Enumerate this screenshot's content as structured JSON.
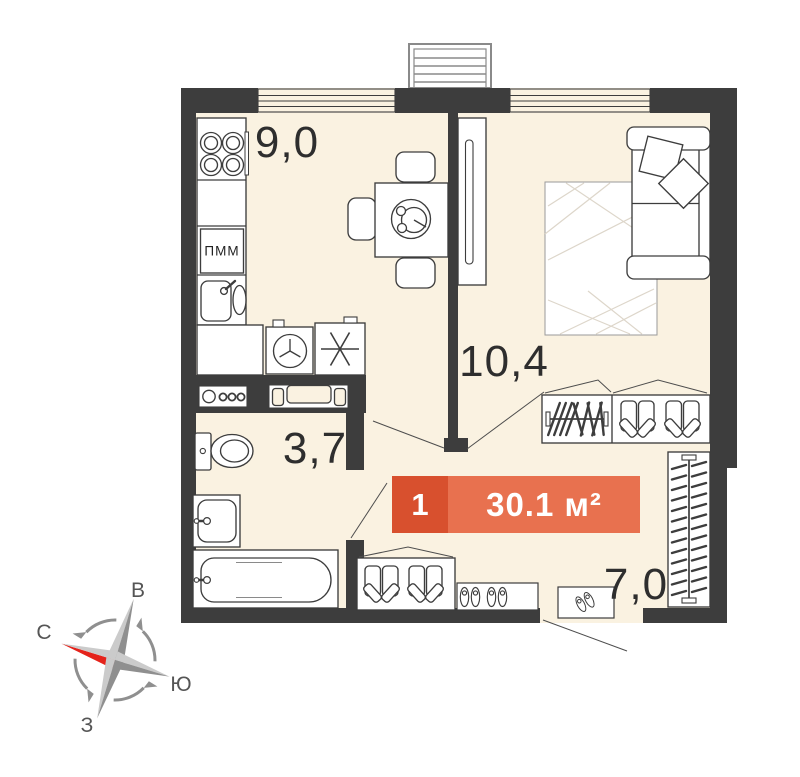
{
  "plan": {
    "rooms": {
      "kitchen": "9,0",
      "living": "10,4",
      "bathroom": "3,7",
      "hallway": "7,0"
    },
    "badge": {
      "number": "1",
      "area": "30.1 м²"
    },
    "labels": {
      "dishwasher": "ПММ"
    },
    "colors": {
      "wall": "#3d3d3d",
      "floor": "#faf2e1",
      "badge_left": "#d8502e",
      "badge_right": "#e8714f",
      "compass_red": "#e5231b"
    }
  },
  "compass": {
    "north": "С",
    "east": "В",
    "south": "Ю",
    "west": "З"
  }
}
